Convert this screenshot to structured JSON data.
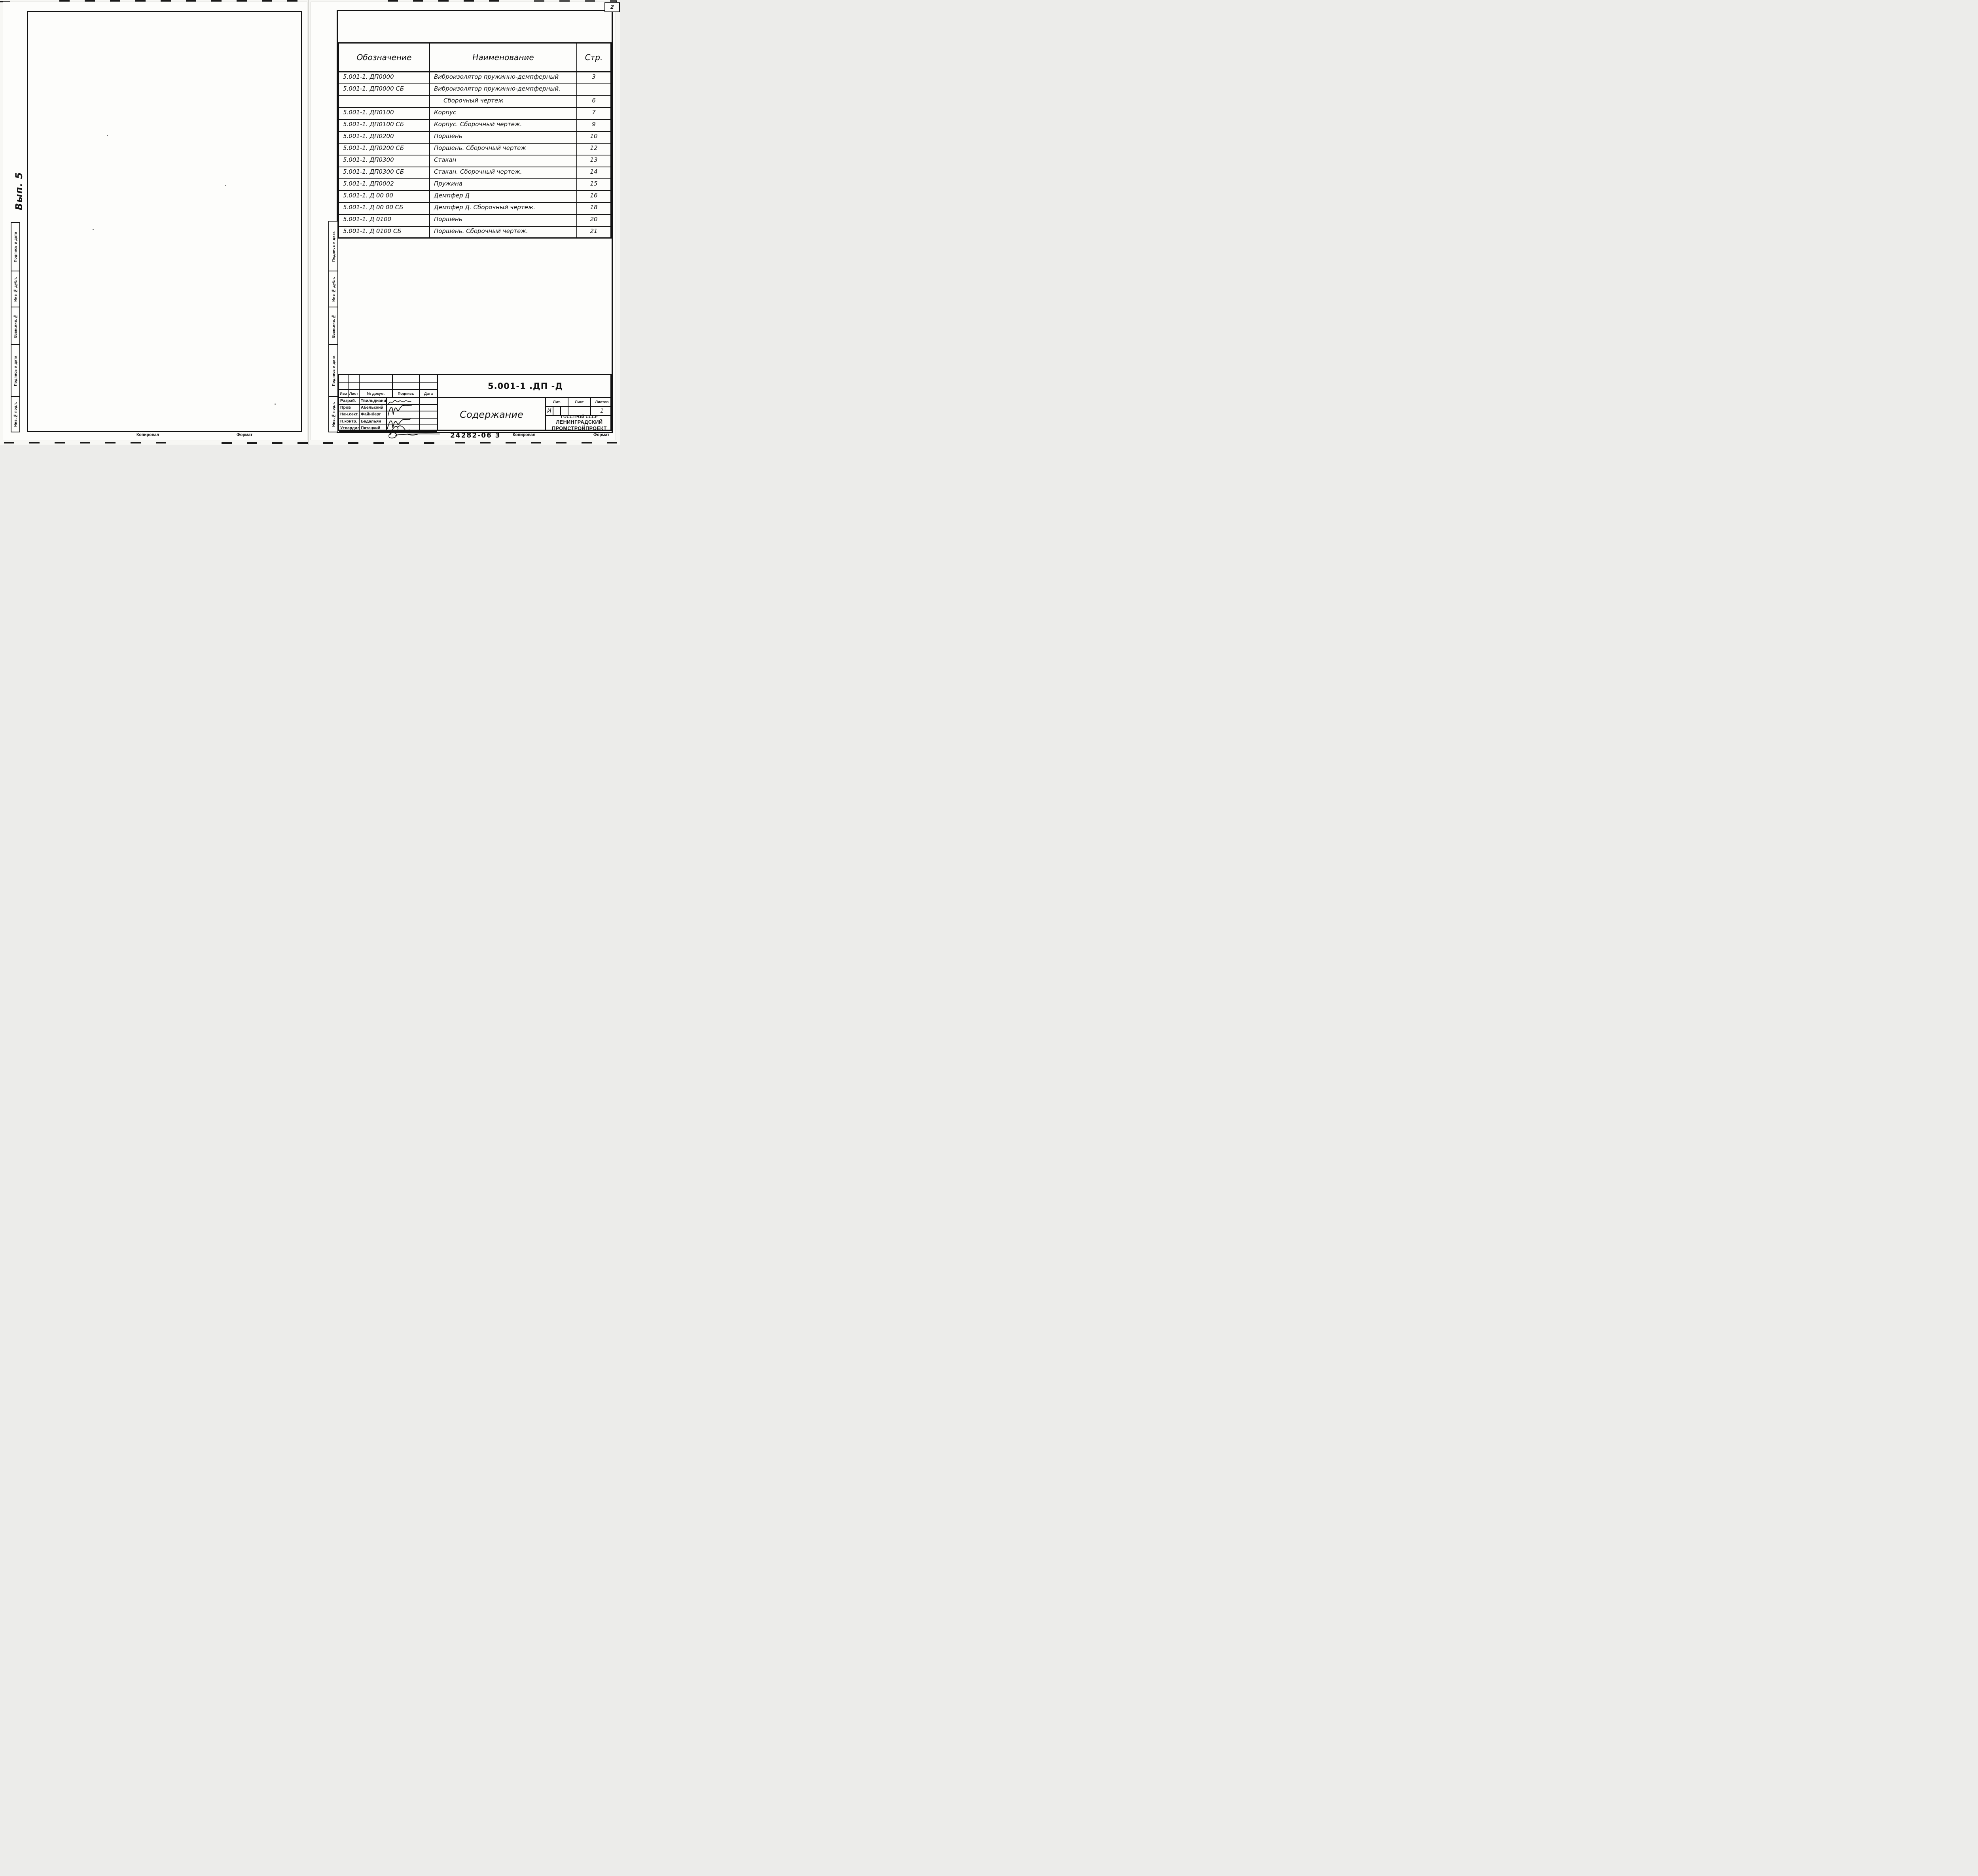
{
  "page_number": "2",
  "left_page": {
    "handwritten_note": "Вып. 5",
    "sidebar_labels": [
      "Подпись и дата",
      "Инв № дубл.",
      "Взам.инв.№",
      "Подпись и дата",
      "Инв.№ подл."
    ],
    "footer": {
      "kopiroval": "Копировал",
      "format": "Формат"
    }
  },
  "right_page": {
    "sidebar_labels": [
      "Подпись и дата",
      "Инв № дубл.",
      "Взам.инв.№",
      "Подпись и дата",
      "Инв.№ подл."
    ],
    "contents_table": {
      "headers": {
        "designation": "Обозначение",
        "name": "Наименование",
        "page": "Стр."
      },
      "rows": [
        {
          "designation": "5.001-1. ДП0000",
          "name": "Виброизолятор пружинно-демпферный",
          "page": "3"
        },
        {
          "designation": "5.001-1. ДП0000 СБ",
          "name": "Виброизолятор пружинно-демпферный.",
          "page": ""
        },
        {
          "designation": "",
          "name": "Сборочный чертеж",
          "page": "6"
        },
        {
          "designation": "5.001-1. ДП0100",
          "name": "Корпус",
          "page": "7"
        },
        {
          "designation": "5.001-1. ДП0100 СБ",
          "name": "Корпус. Сборочный чертеж.",
          "page": "9"
        },
        {
          "designation": "5.001-1. ДП0200",
          "name": "Поршень",
          "page": "10"
        },
        {
          "designation": "5.001-1. ДП0200 СБ",
          "name": "Поршень. Сборочный чертеж",
          "page": "12"
        },
        {
          "designation": "5.001-1. ДП0300",
          "name": "Стакан",
          "page": "13"
        },
        {
          "designation": "5.001-1. ДП0300 СБ",
          "name": "Стакан. Сборочный чертеж.",
          "page": "14"
        },
        {
          "designation": "5.001-1. ДП0002",
          "name": "Пружина",
          "page": "15"
        },
        {
          "designation": "5.001-1. Д 00 00",
          "name": "Демпфер Д",
          "page": "16"
        },
        {
          "designation": "5.001-1. Д 00 00 СБ",
          "name": "Демпфер Д. Сборочный чертеж.",
          "page": "18"
        },
        {
          "designation": "5.001-1. Д 0100",
          "name": "Поршень",
          "page": "20"
        },
        {
          "designation": "5.001-1. Д 0100 СБ",
          "name": "Поршень. Сборочный чертеж.",
          "page": "21"
        }
      ]
    },
    "title_block": {
      "revision_headers": [
        "Изм",
        "Лист",
        "№ докум.",
        "Подпись",
        "Дата"
      ],
      "sign_rows": [
        {
          "role": "Разраб.",
          "name": "Твильдиани"
        },
        {
          "role": "Пров",
          "name": "Абельский"
        },
        {
          "role": "Нач.сект.",
          "name": "Файнберг"
        },
        {
          "role": "Н.контр.",
          "name": "Бадальян"
        },
        {
          "role": "Утвердил",
          "name": "Пятецкий"
        }
      ],
      "document_code": "5.001-1 .ДП -Д",
      "document_title": "Содержание",
      "lit_header": "Лит.",
      "lit_value": "И",
      "sheet_header": "Лист",
      "sheet_value": "",
      "sheets_header": "Листов",
      "sheets_value": "1",
      "organization": [
        "ГОССТРОЙ СССР",
        "ЛЕНИНГРАДСКИЙ",
        "ПРОМСТРОЙПРОЕКТ"
      ]
    },
    "footer": {
      "doc_number": "24282-06 3",
      "kopiroval": "Копировал",
      "format": "Формат"
    }
  }
}
